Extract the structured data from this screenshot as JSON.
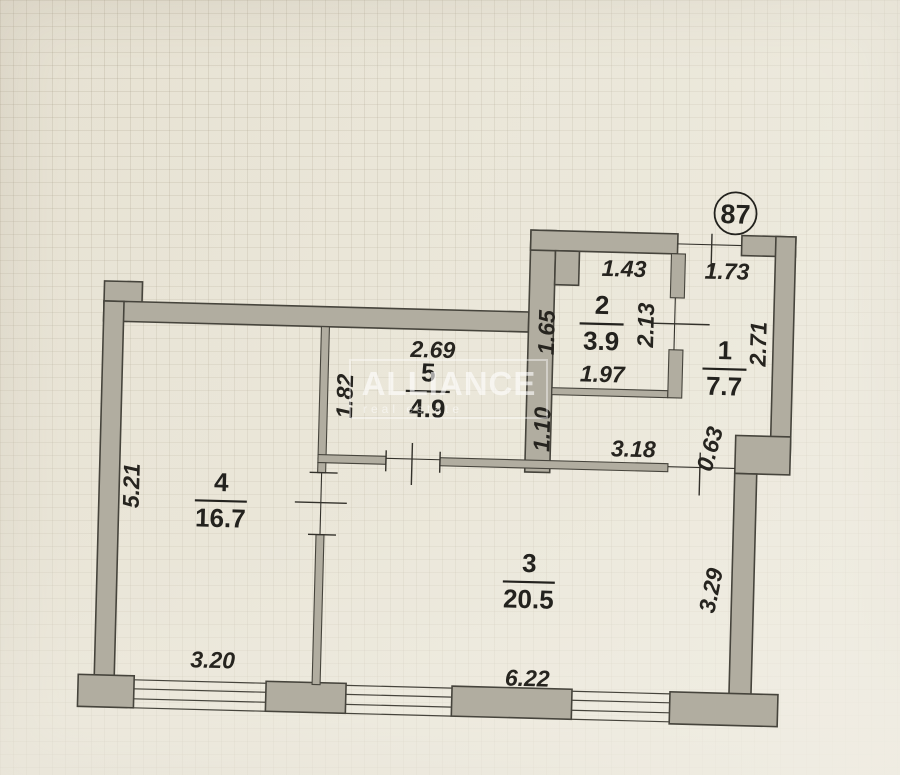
{
  "plan": {
    "apartment_number": "87",
    "watermark": {
      "title": "ALLIANCE",
      "subtitle": "real estate"
    },
    "rooms": [
      {
        "number": "1",
        "area": "7.7"
      },
      {
        "number": "2",
        "area": "3.9"
      },
      {
        "number": "3",
        "area": "20.5"
      },
      {
        "number": "4",
        "area": "16.7"
      },
      {
        "number": "5",
        "area": "4.9"
      }
    ],
    "dims": {
      "room2_top": "1.43",
      "room1_top": "1.73",
      "room2_left": "1.65",
      "room2_right": "2.13",
      "room1_right": "2.71",
      "room2_bottom": "1.97",
      "room5_top": "2.69",
      "room5_left": "1.82",
      "hall_left": "1.10",
      "hall_length": "3.18",
      "hall_door": "0.63",
      "room4_left": "5.21",
      "room3_right": "3.29",
      "room4_window": "3.20",
      "room3_bottom": "6.22"
    },
    "colors": {
      "paper": "#eae6d9",
      "wall_fill": "#b1ada0",
      "line_ink": "#33312b",
      "watermark": "#ffffff"
    }
  }
}
